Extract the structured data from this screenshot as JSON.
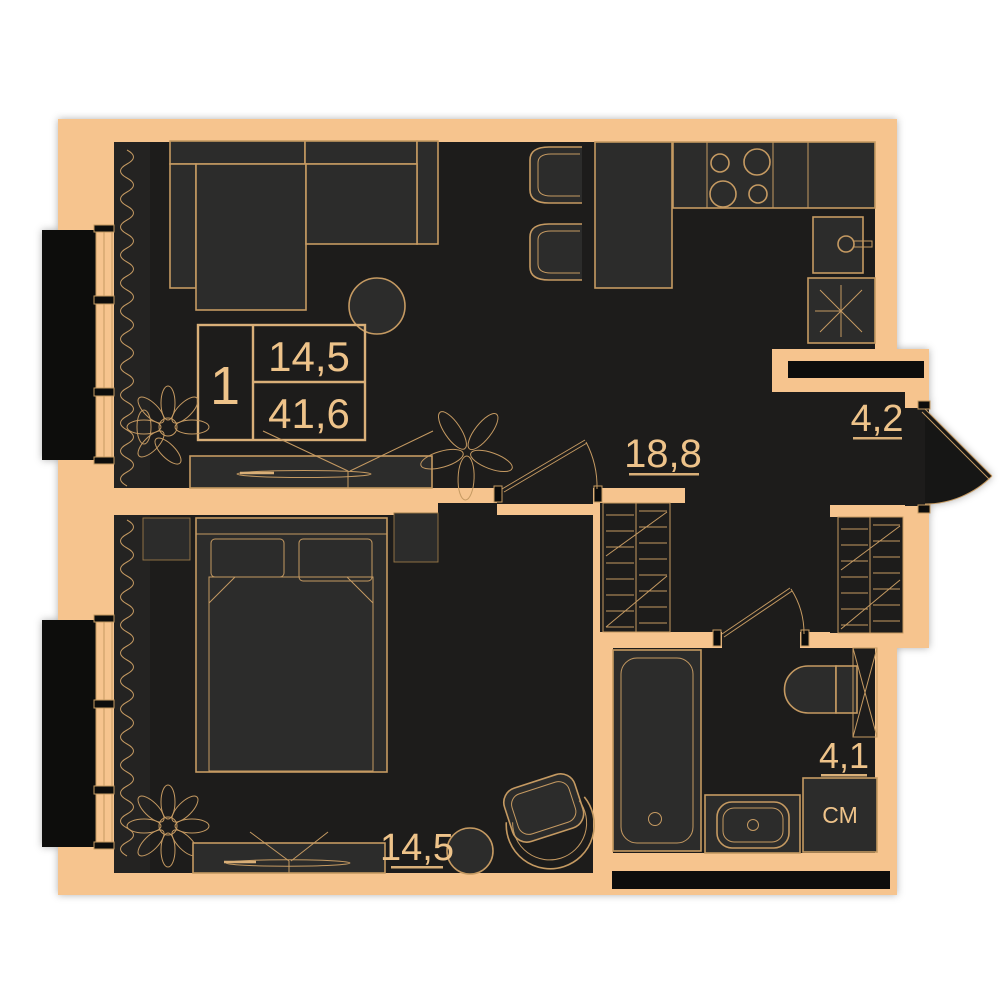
{
  "title": "Apartment floor plan",
  "info_box": {
    "room_count": "1",
    "living_area": "14,5",
    "total_area": "41,6"
  },
  "labels": {
    "kitchen_living": "18,8",
    "entrance_hall": "4,2",
    "bedroom": "14,5",
    "bathroom": "4,1",
    "washing_machine": "СМ"
  },
  "colors": {
    "background": "#ffffff",
    "wall": "#f6c48e",
    "interior": "#1d1c1b",
    "furniture_fill": "#2c2c2b",
    "outline": "#c59a62",
    "text": "#eec38a",
    "exterior_black": "#0d0d0c"
  },
  "furniture": [
    "corner-sofa",
    "coffee-table",
    "area-info-box",
    "tv-stand",
    "plant",
    "dining-table",
    "chair",
    "kitchen-counter",
    "stove",
    "kitchen-sink",
    "vent-shaft",
    "wardrobe",
    "entrance-door",
    "interior-door",
    "bed",
    "nightstand",
    "armchair",
    "side-table",
    "bathtub",
    "toilet",
    "bathroom-sink",
    "washing-machine",
    "window",
    "curtain"
  ]
}
